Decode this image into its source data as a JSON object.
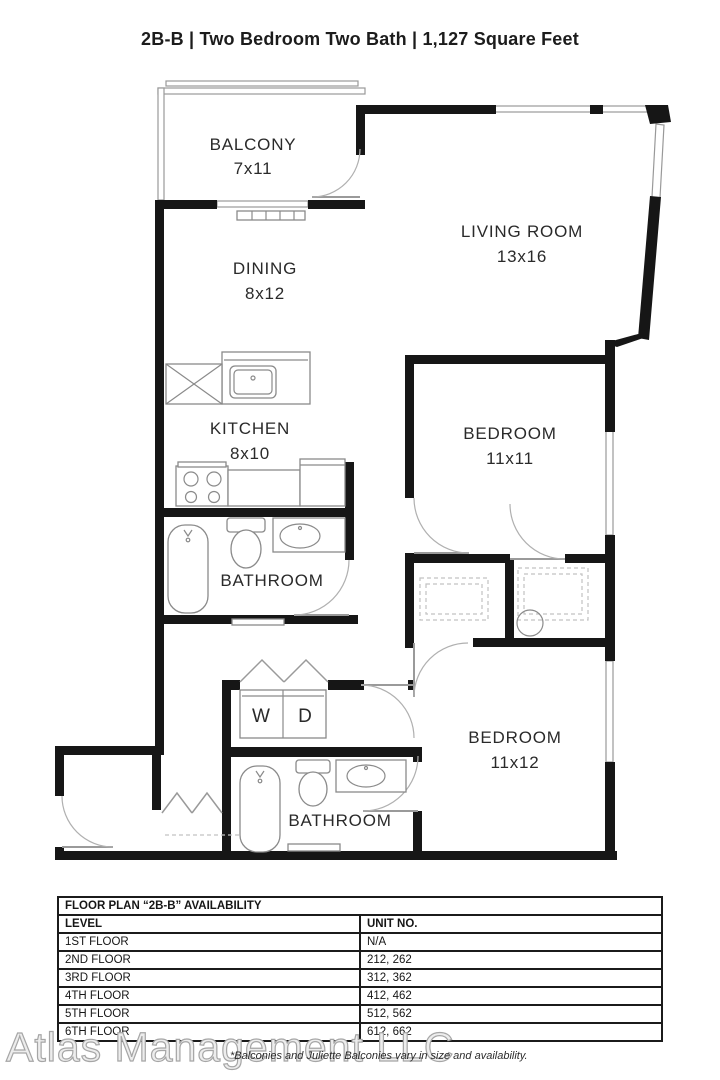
{
  "title": "2B-B | Two Bedroom Two Bath | 1,127 Square Feet",
  "plan": {
    "balcony": {
      "name": "BALCONY",
      "dims": "7x11"
    },
    "living_room": {
      "name": "LIVING ROOM",
      "dims": "13x16"
    },
    "dining": {
      "name": "DINING",
      "dims": "8x12"
    },
    "kitchen": {
      "name": "KITCHEN",
      "dims": "8x10"
    },
    "bedroom_1": {
      "name": "BEDROOM",
      "dims": "11x11"
    },
    "bathroom_1": {
      "name": "BATHROOM"
    },
    "washer": "W",
    "dryer": "D",
    "bathroom_2": {
      "name": "BATHROOM"
    },
    "bedroom_2": {
      "name": "BEDROOM",
      "dims": "11x12"
    }
  },
  "availability_table": {
    "title": "FLOOR PLAN “2B-B” AVAILABILITY",
    "columns": [
      "LEVEL",
      "UNIT NO."
    ],
    "rows": [
      [
        "1ST FLOOR",
        "N/A"
      ],
      [
        "2ND FLOOR",
        "212, 262"
      ],
      [
        "3RD FLOOR",
        "312, 362"
      ],
      [
        "4TH FLOOR",
        "412, 462"
      ],
      [
        "5TH FLOOR",
        "512, 562"
      ],
      [
        "6TH FLOOR",
        "612, 662"
      ]
    ]
  },
  "footer": {
    "watermark": "Atlas Management LLC",
    "note": "*Balconies and Juliette Balconies vary in size and availability."
  }
}
